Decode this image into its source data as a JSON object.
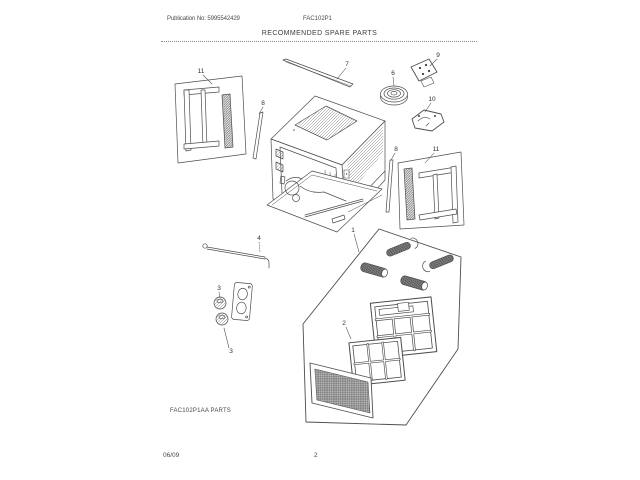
{
  "header": {
    "publication": "Publication No: 5995542429",
    "model": "FAC102P1",
    "title": "RECOMMENDED SPARE PARTS"
  },
  "diagram": {
    "caption": "FAC102P1AA PARTS",
    "callouts": [
      "11",
      "8",
      "7",
      "6",
      "9",
      "10",
      "8",
      "11",
      "4",
      "3",
      "3",
      "1",
      "2"
    ]
  },
  "footer": {
    "date": "06/09",
    "page_number": "2"
  }
}
